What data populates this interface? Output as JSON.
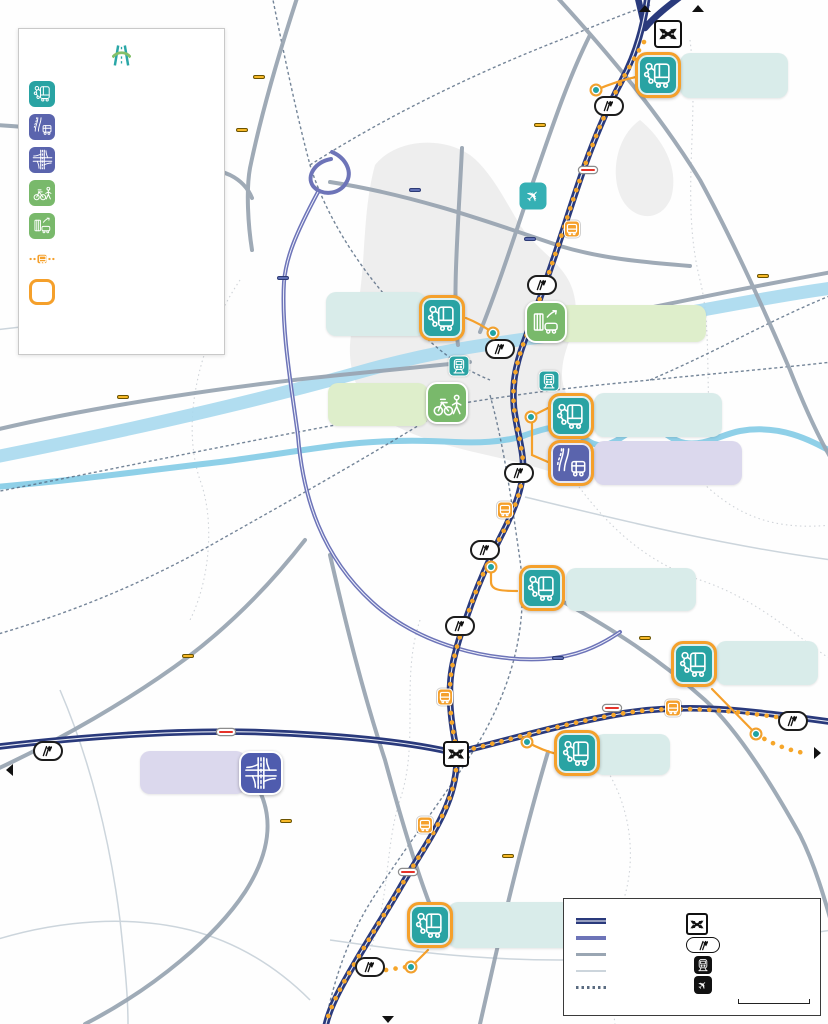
{
  "colors": {
    "teal": "#2aa7a7",
    "green": "#84c06a",
    "purple": "#5a64ad",
    "orange": "#f5a02b",
    "motorway": "#2a3a7c",
    "badge_red": "#e6332a",
    "badge_yellow": "#f7b928",
    "badge_blue": "#5f6fb4",
    "river": "#9fd4ea"
  },
  "title_card": {
    "line1": "PROJETS DE",
    "line2_prefix": "L’",
    "line2_rest": "UTOROUTE",
    "line3_word1": "BAS ",
    "line3_word2": "CARBONE",
    "line4_prefix": "EN ",
    "line4_rest": "TOURAINE",
    "items": [
      {
        "icon": "pem-icon",
        "label": "Projet de Pôle d'Echange Multimodal (PEM)"
      },
      {
        "icon": "interchange-multimodal-icon",
        "label": "Projet d'échangeur multimodal autoroutier"
      },
      {
        "icon": "interchange-icon",
        "label": "Projet d'échangeur autoroutier"
      },
      {
        "icon": "footbridge-icon",
        "label": "Projet de passerelles piétons-vélos"
      },
      {
        "icon": "acoustic-screen-icon",
        "label": "Projet d'écrans acoustiques"
      },
      {
        "icon": "express-line-icon",
        "label": "Projet de ligne de car express sur autoroute"
      },
      {
        "icon": "express-stop-icon",
        "label": "Arrêt de la ligne de car express"
      }
    ]
  },
  "map_legend": {
    "title": "LÉGENDE CARTOGRAPHIE",
    "rows": [
      "Autoroute",
      "Boulevard périphérique",
      "Axes principaux",
      "Axes secondaires",
      "Voies ferrées"
    ],
    "symbols": {
      "noeud": "Nœud autoroutier",
      "noeud_sub": "(échangeur interautoroutes)",
      "acces": "Accès autoroute",
      "gare": "Gare métropolitaine",
      "aeroport": "Aéroport",
      "scale": "1 km"
    }
  },
  "badges": {
    "d938": "D938",
    "d959": "D959",
    "d910_top": "D910",
    "d952_w": "D952",
    "d952_e": "D952",
    "d751": "D751",
    "d943": "D943",
    "d86": "D86",
    "d910_s": "D910",
    "m801_a": "M801",
    "m801_b": "M801",
    "m37_w": "M37",
    "m37_s": "M37",
    "a10_n": "A10",
    "a10_s": "A10",
    "a85_w": "A85",
    "a85_e": "A85"
  },
  "exits": {
    "e19": "19",
    "e20": "20",
    "e21": "21",
    "e22": "22",
    "e23": "23",
    "e24": "24",
    "e241": "24.1",
    "e9": "9",
    "e10": "10"
  },
  "areas": {
    "parcay": "PARÇAY-\nMESLAY",
    "rochecorbon": "ROCHECORBON",
    "tours": "TOURS",
    "stpierre": "SAINT-PIERRE-DES-CORPS",
    "stavertin": "SAINT-AVERTIN",
    "chambray": "CHAMBRAY-\nLÈS-TOURS",
    "joue": "JOUÉ-LÈS-TOURS",
    "esvres": "ESVRES-\nSUR-INDRE",
    "monts": "MONTS",
    "veigne": "VEIGNÉ",
    "sorigny": "SORIGNY"
  },
  "markers": {
    "pem_parcay": "PEM de\nParçay-Meslay",
    "pem_tours_centre": "PEM de\nTours-Centre",
    "ecrans": "Écrans acoustiques",
    "passerelles": "Passerelles\npiétons-vélos",
    "pem_rochepinard": "PEM de\nTours-Rochepinard",
    "echangeur_rochepinard": "Échangeur multimodal\nde Rochepinard",
    "pem_chambray": "PEM de\nChambray-lès-Tours",
    "pem_esvres": "PEM d’Esvres-\nsur-Indre",
    "pem_veigne": "PEM\nde Veigné",
    "echangeur_joue": "Échangeur de\nJoué-lès-Tours",
    "pem_sorigny": "PEM\nde Sorigny"
  },
  "pois": {
    "gare_tours": "Gare\nde TOURS",
    "gare_tgv": "Gare TGV de\nSaint-Pierre-des-Corps",
    "aeroport": "Aéroport de\nTours - Val de Loire"
  },
  "directions": {
    "le_mans": "Vers\nLE MANS\n(A28)",
    "paris": "Vers\nPARIS",
    "angers": "Vers\nANGERS",
    "vierzon": "Vers\nVIE-",
    "bordeaux": "Vers\nBORDEAUX"
  },
  "rivers": {
    "loire": "La Loire",
    "cher": "Le Cher"
  },
  "road_names": {
    "route_de_monts": "Route de Monts"
  }
}
